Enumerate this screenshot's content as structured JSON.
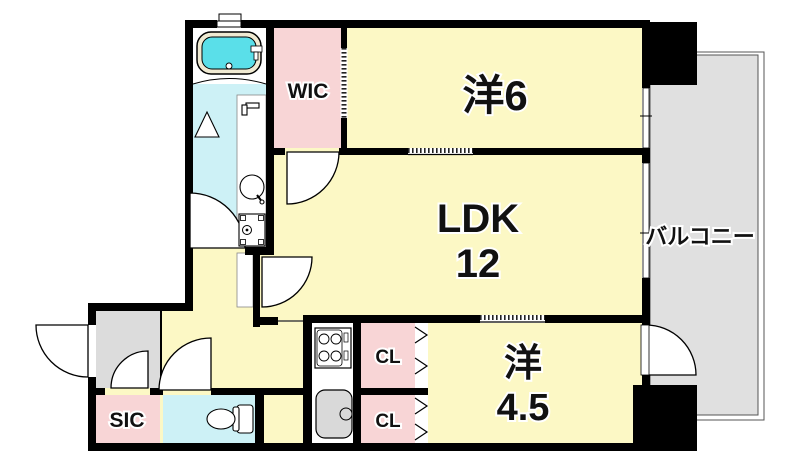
{
  "floorplan": {
    "rooms": {
      "western6": {
        "label": "洋6"
      },
      "ldk": {
        "label": "LDK",
        "size_label": "12"
      },
      "western45": {
        "label": "洋",
        "size_label": "4.5"
      },
      "wic": {
        "label": "WIC"
      },
      "sic": {
        "label": "SIC"
      },
      "closet_upper": {
        "label": "CL"
      },
      "closet_lower": {
        "label": "CL"
      },
      "balcony": {
        "label": "バルコニー"
      }
    },
    "fixtures": {
      "bathtub": "bathtub-icon",
      "vanity_basin": "wash-basin-icon",
      "washing_machine": "washing-machine-icon",
      "toilet": "toilet-icon",
      "stove": "gas-stove-icon",
      "kitchen_sink": "kitchen-sink-icon"
    },
    "colors": {
      "room_yellow": "#fcf8c5",
      "closet_pink": "#f8d5d6",
      "wet_area_cyan": "#cdf1f6",
      "tub_water_cyan": "#5adfe9",
      "tub_rim_cream": "#f0ead2",
      "balcony_gray": "#e0e0e0",
      "entry_gray": "#dcdcdc",
      "wall_black": "#000000",
      "sink_gray": "#d9d9d9"
    }
  }
}
